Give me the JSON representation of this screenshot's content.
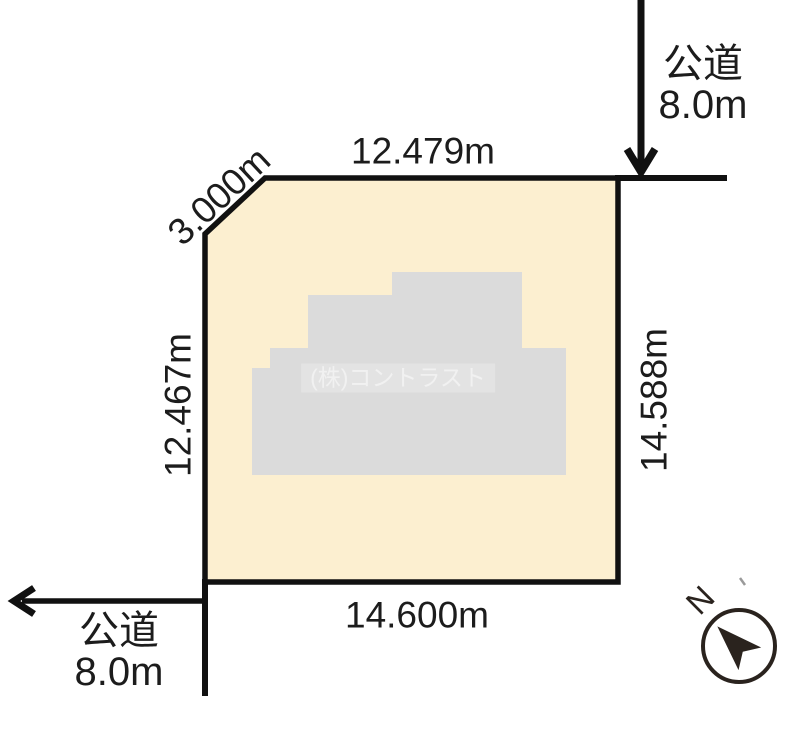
{
  "colors": {
    "line": "#111111",
    "text": "#1c1c1c",
    "parcel-fill": "#fcefd0",
    "building-fill": "#dbdbdb",
    "watermark-band": "#e3e3e3",
    "watermark-text": "#f1f1f1",
    "compass": "#2a231e",
    "tick": "#9a9a9a"
  },
  "parcel": {
    "dim_top": "12.479m",
    "dim_chamfer": "3.000m",
    "dim_left": "12.467m",
    "dim_right": "14.588m",
    "dim_bottom": "14.600m"
  },
  "roads": {
    "top": {
      "name": "公道",
      "width": "8.0m"
    },
    "bottom": {
      "name": "公道",
      "width": "8.0m"
    }
  },
  "watermark": {
    "text": "(株)コントラスト"
  },
  "compass": {
    "label": "N"
  }
}
